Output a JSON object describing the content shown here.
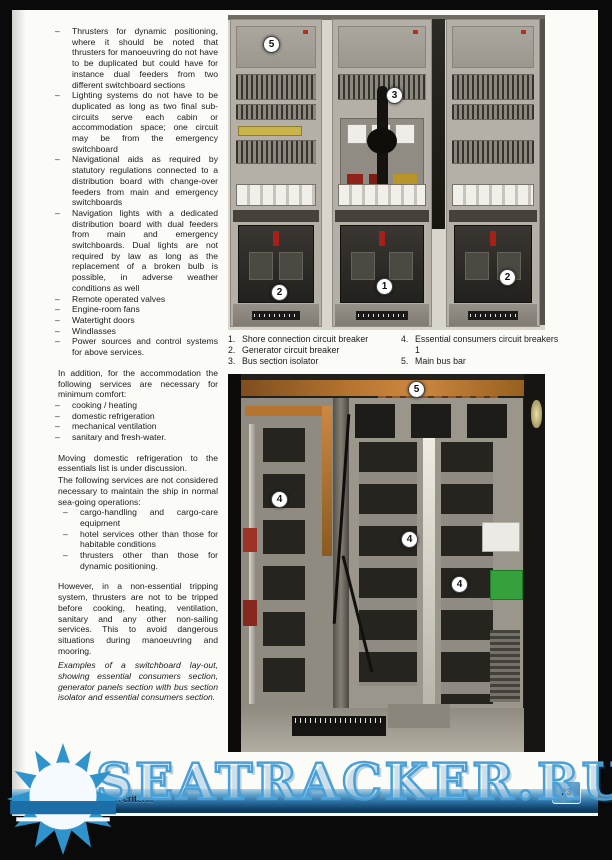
{
  "dash": "–",
  "left_column": {
    "bullets_main": [
      "Thrusters for dynamic positioning, where it should be noted that thrusters for manoeuvring do not have to be duplicated but could have for instance dual feeders from two different switchboard sections",
      "Lighting systems do not have to be duplicated as long as two final sub-circuits serve each cabin or accommodation space; one circuit may be from the emergency switchboard",
      "Navigational aids as required by statutory regulations connected to a distribution board with change-over feeders from main and emergency switchboards",
      "Navigation lights with a dedicated distribution board with dual feeders from main and emergency switchboards. Dual lights are not required by law as long as the replacement of a broken bulb is possible, in adverse weather conditions as well",
      "Remote operated valves",
      "Engine-room fans",
      "Watertight doors",
      "Windlasses",
      "Power sources and control systems for above services."
    ],
    "para_accommodation": "In addition, for the accommodation the following services are necessary for minimum comfort:",
    "bullets_comfort": [
      "cooking / heating",
      "domestic refrigeration",
      "mechanical ventilation",
      "sanitary and fresh-water."
    ],
    "para_moving": "Moving domestic refrigeration to the essentials list is under discussion.",
    "para_following": "The following services are not considered necessary to maintain the ship in normal sea-going operations:",
    "bullets_nonessential": [
      "cargo-handling and cargo-care equipment",
      "hotel services other than those for habitable conditions",
      "thrusters other than those for dynamic positioning."
    ],
    "para_however": "However, in a non-essential tripping system, thrusters are not to be tripped before cooking, heating, ventilation, sanitary and any other non-sailing services. This to avoid dangerous situations during manoeuvring and mooring.",
    "caption_italic": "Examples of a switchboard lay-out, showing essential consumers section, generator panels section with bus section isolator and essential consumers section."
  },
  "photo_caption": {
    "left": [
      {
        "num": "1.",
        "text": "Shore connection circuit breaker"
      },
      {
        "num": "2.",
        "text": "Generator circuit breaker"
      },
      {
        "num": "3.",
        "text": "Bus section isolator"
      }
    ],
    "right": [
      {
        "num": "4.",
        "text": "Essential consumers circuit breakers 1"
      },
      {
        "num": "5.",
        "text": "Main bus bar"
      }
    ]
  },
  "top_photo": {
    "callouts": [
      "5",
      "3",
      "2",
      "1",
      "2"
    ]
  },
  "bottom_photo": {
    "callouts": [
      "5",
      "4",
      "4",
      "4"
    ]
  },
  "footer": {
    "section_title": "3. Basic design criteria",
    "page_number": "23"
  },
  "watermark": {
    "text": "SEATRACKER.RU"
  },
  "colors": {
    "footer_blue": "#2a6da0",
    "watermark_blue": "#4aa0d6",
    "copper_busbar": "#b5742f",
    "callout_background": "#ffffff"
  }
}
